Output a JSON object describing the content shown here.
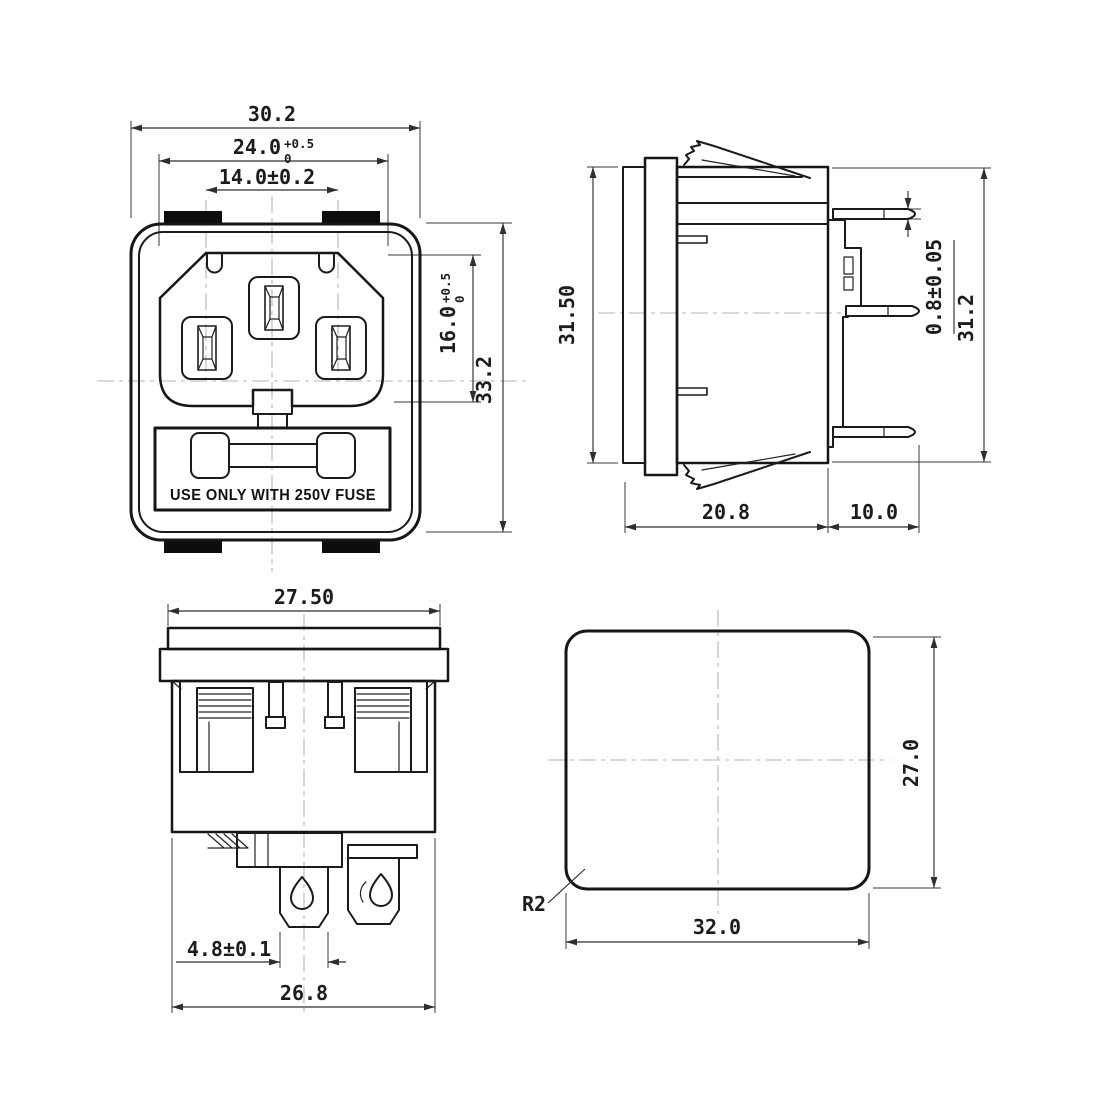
{
  "front": {
    "overall_width": "30.2",
    "opening_width": "24.0",
    "opening_width_tol_upper": "+0.5",
    "opening_width_tol_lower": "0",
    "pin_pitch": "14.0±0.2",
    "opening_height": "16.0",
    "opening_height_tol_upper": "+0.5",
    "opening_height_tol_lower": "0",
    "overall_height": "33.2",
    "fuse_warning": "USE ONLY WITH 250V FUSE"
  },
  "side": {
    "panel_height": "31.50",
    "pin_thickness": "0.8±0.05",
    "rear_height": "31.2",
    "body_depth": "20.8",
    "pin_length": "10.0"
  },
  "bottom": {
    "cap_width": "27.50",
    "terminal_width": "4.8±0.1",
    "body_width": "26.8"
  },
  "cutout": {
    "width": "32.0",
    "height": "27.0",
    "corner_radius": "R2"
  }
}
